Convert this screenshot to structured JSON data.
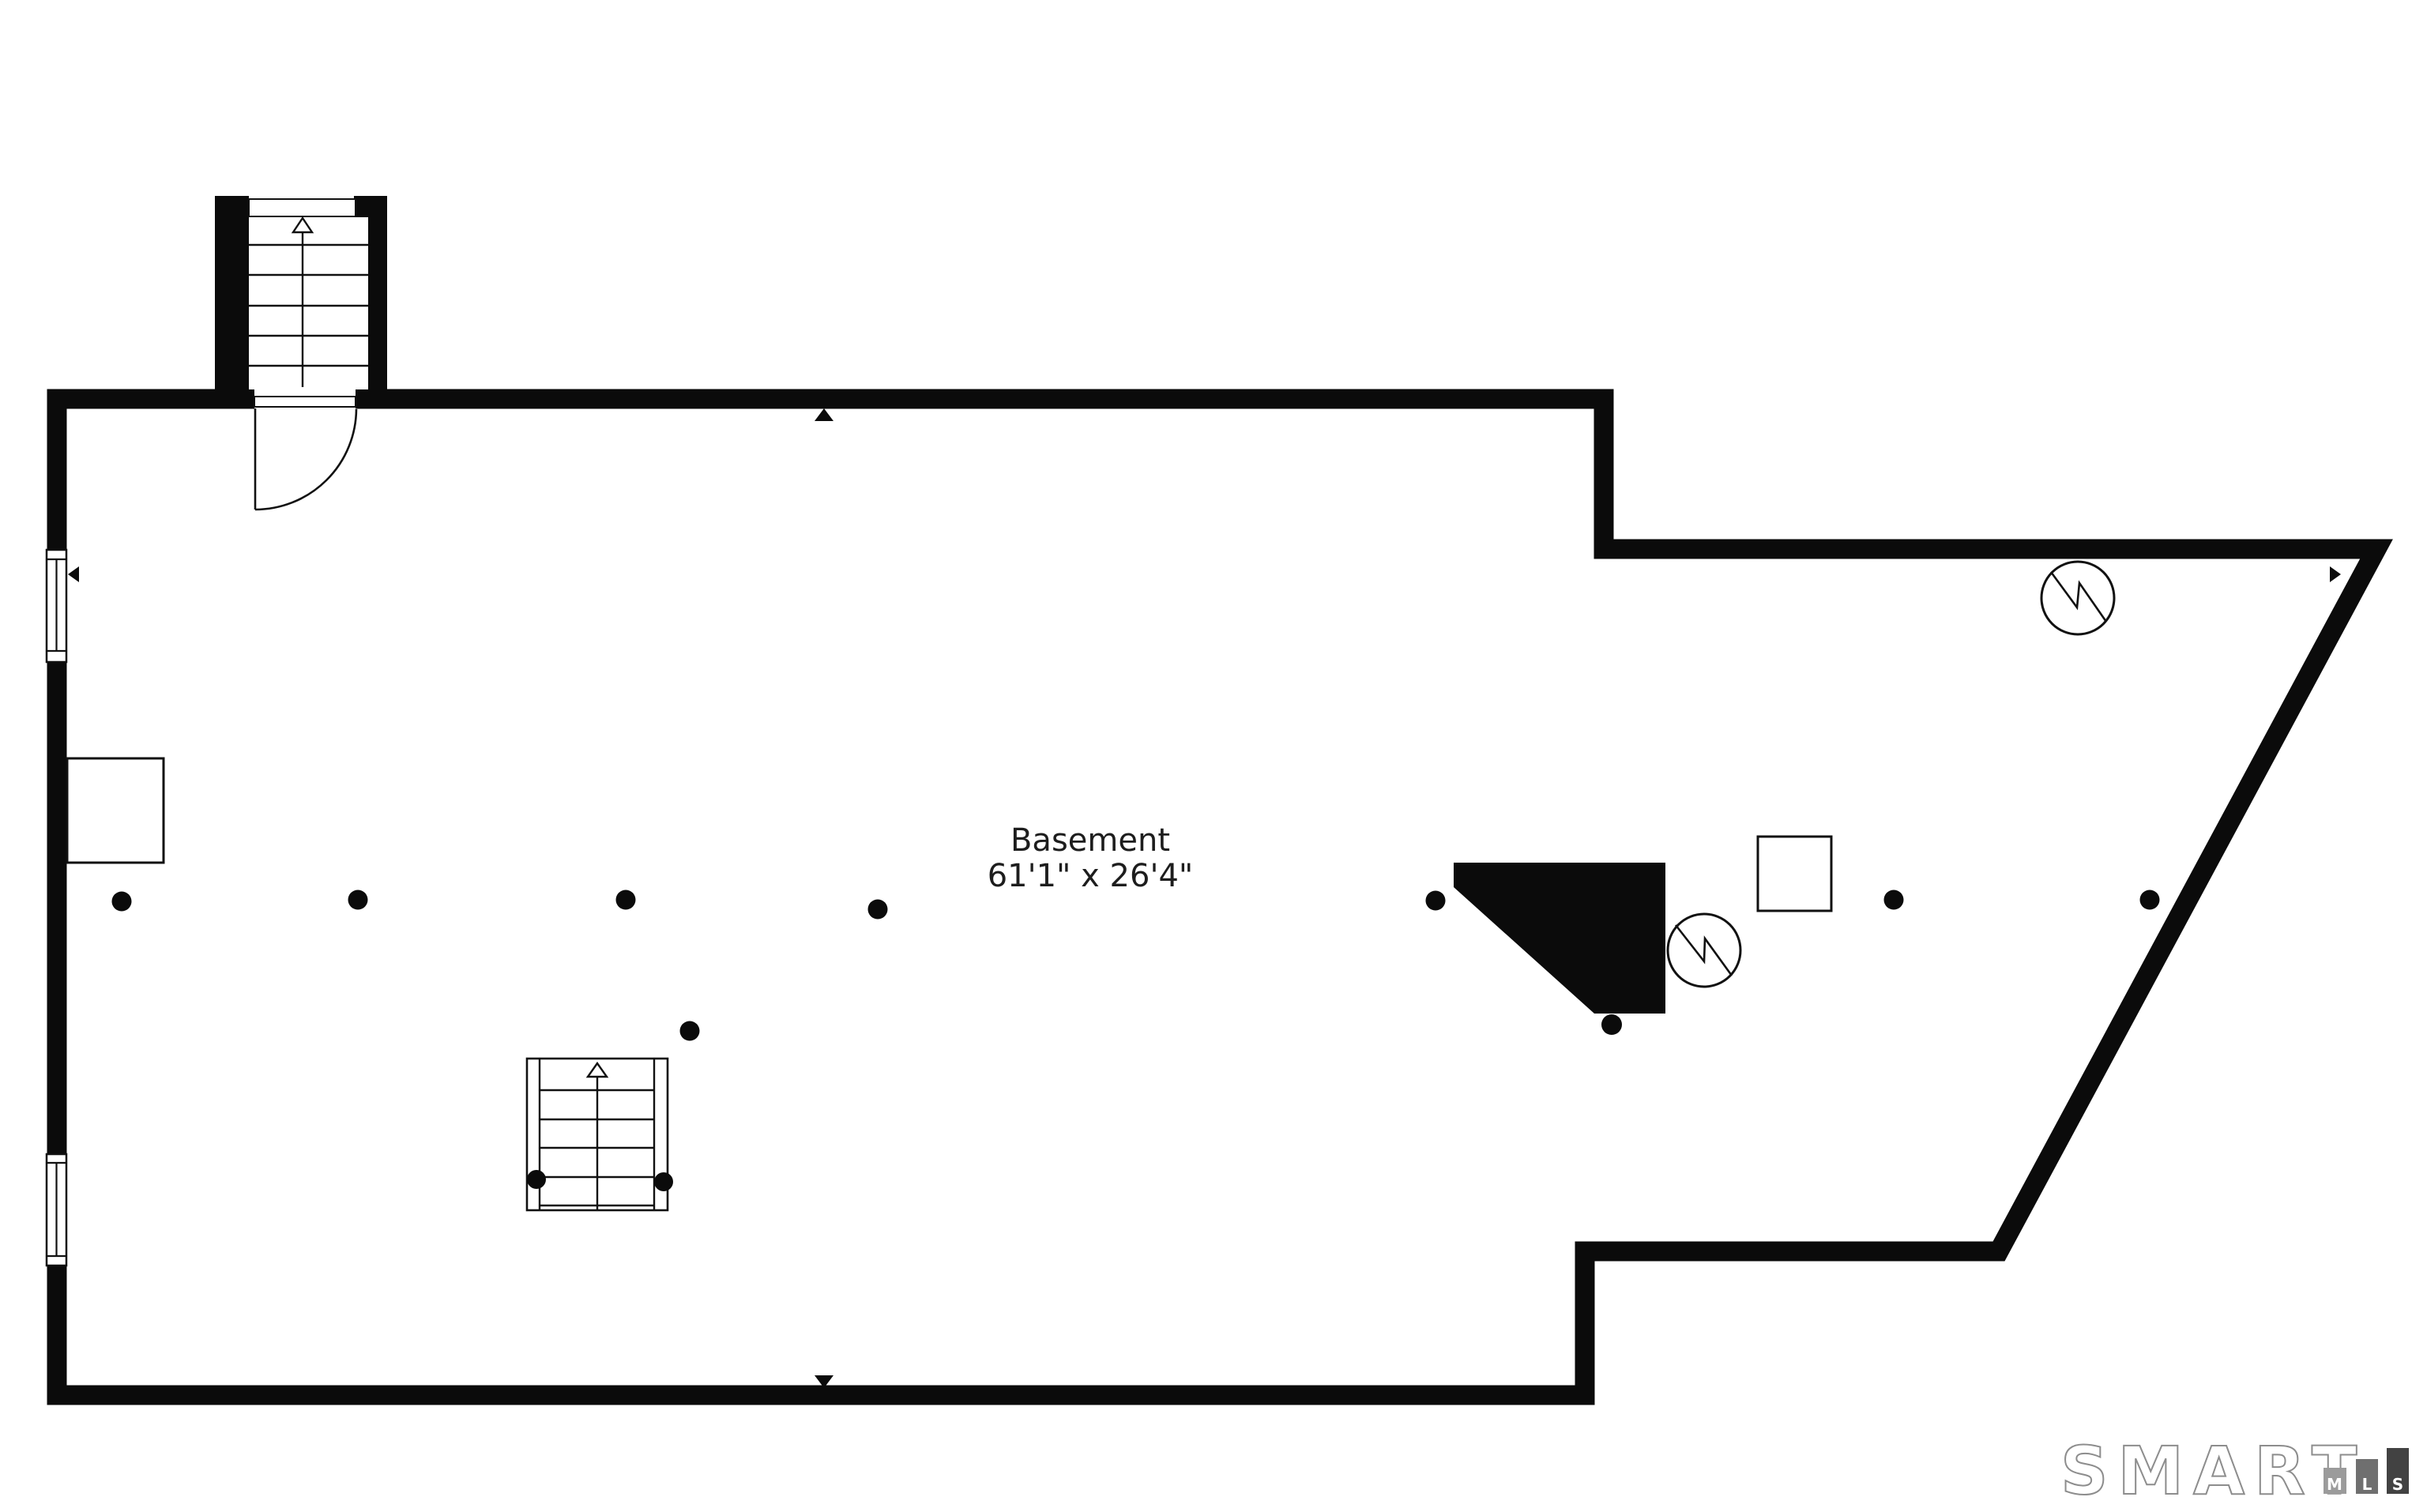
{
  "floorplan": {
    "room_label": "Basement",
    "room_dimensions": "61'1\" x 26'4\""
  },
  "branding": {
    "logo_text": "SMART",
    "logo_bars": [
      {
        "label": "M",
        "color": "#9b9b9b"
      },
      {
        "label": "L",
        "color": "#6f6f6f"
      },
      {
        "label": "S",
        "color": "#424242"
      }
    ]
  },
  "colors": {
    "wall": "#0b0b0b",
    "floor": "#ffffff",
    "line": "#111111",
    "label_text": "#1d1d1d",
    "logo_outline": "#8d8d8d"
  },
  "symbols": {
    "stairs_up_count": 2,
    "column_dot_count": 11,
    "utility_circle_count": 2,
    "window_count": 2,
    "door_count": 1
  }
}
